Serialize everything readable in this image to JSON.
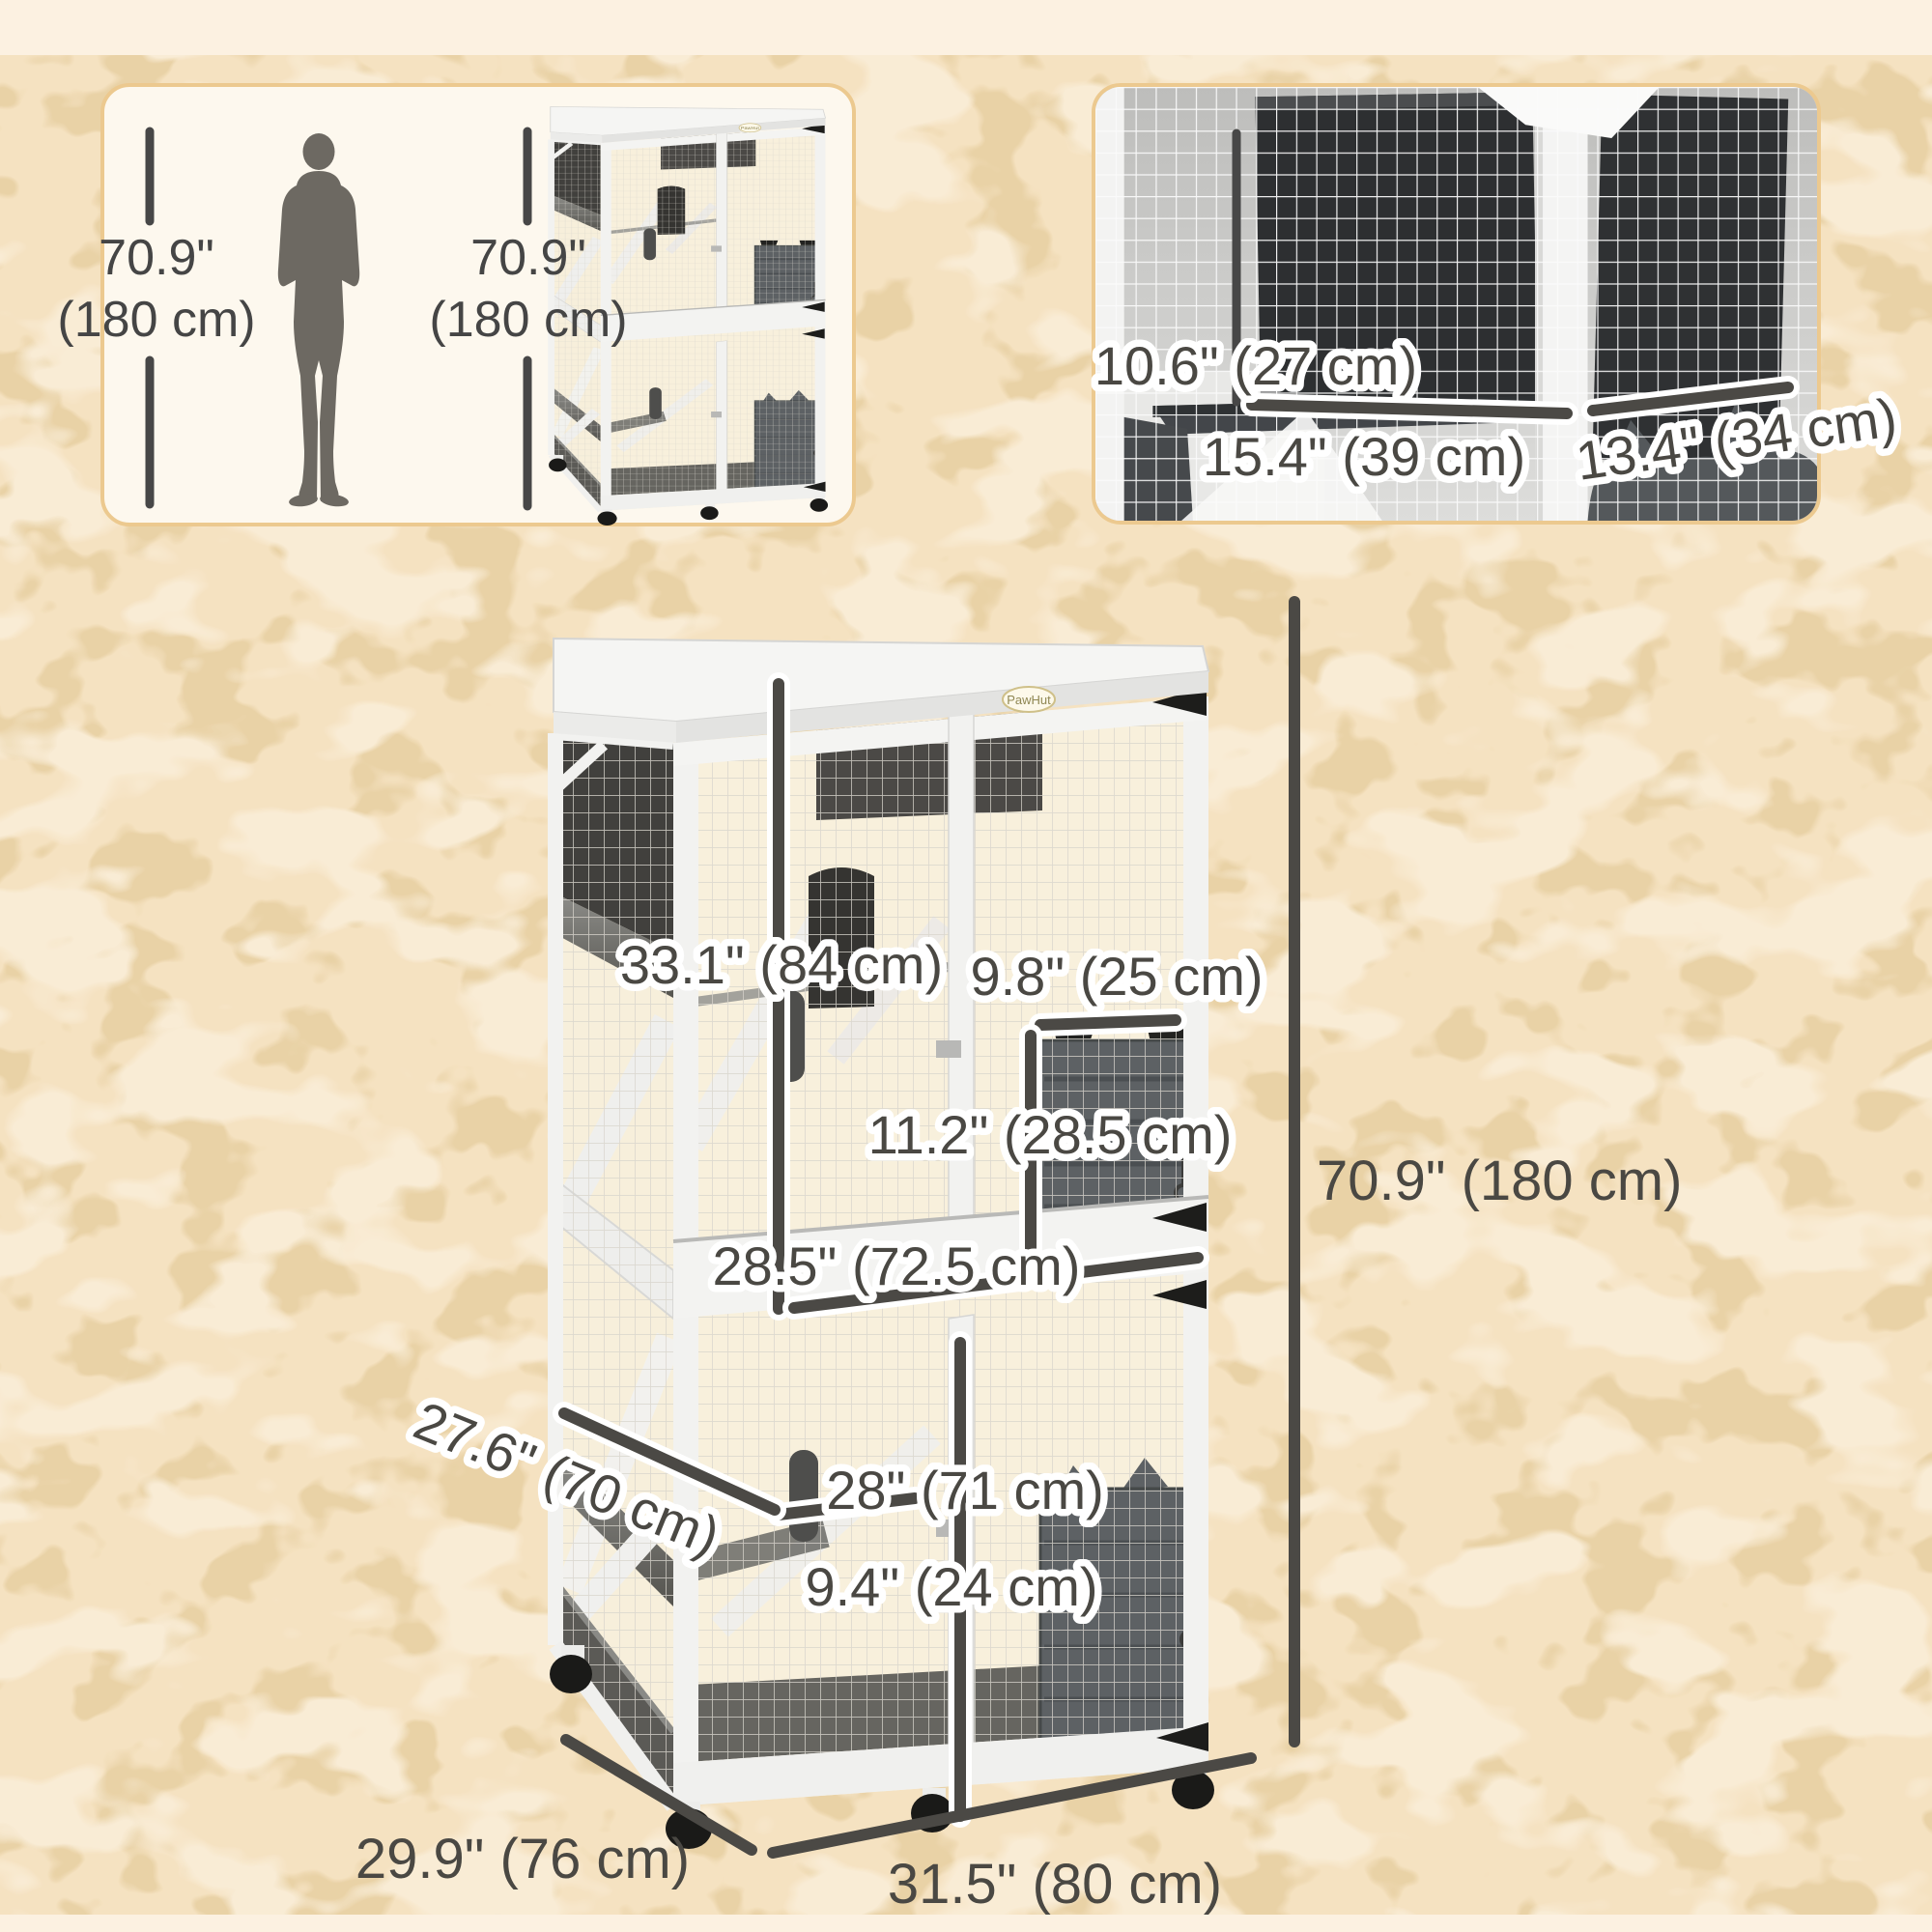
{
  "colors": {
    "background_texture": "#f5e2c1",
    "background_band": "#fcf1e1",
    "panel_border": "#ecc98f",
    "panel_fill": "#fdf8ee",
    "dimension_text": "#4a4843",
    "silhouette": "#6d6962",
    "cage_frame": "#f2f2f0",
    "cage_door": "#5d6164"
  },
  "size_reference_panel": {
    "person_height_in": "70.9\"",
    "person_height_cm": "(180 cm)",
    "product_height_in": "70.9\"",
    "product_height_cm": "(180 cm)"
  },
  "detail_panel": {
    "top_clearance": "10.6\" (27 cm)",
    "left_platform_width": "15.4\" (39 cm)",
    "right_platform_width": "13.4\" (34 cm)"
  },
  "main_dimensions": {
    "upper_platform_width": "33.1\" (84 cm)",
    "hatch_width": "9.8\" (25 cm)",
    "hatch_height": "11.2\" (28.5 cm)",
    "inner_width": "28.5\" (72.5 cm)",
    "lower_section_height": "28\" (71 cm)",
    "shelf_depth": "9.4\" (24 cm)",
    "side_depth": "27.6\" (70 cm)",
    "overall_height": "70.9\" (180 cm)",
    "overall_depth": "29.9\" (76 cm)",
    "overall_width": "31.5\" (80 cm)"
  },
  "brand": {
    "logo": "PawHut"
  }
}
